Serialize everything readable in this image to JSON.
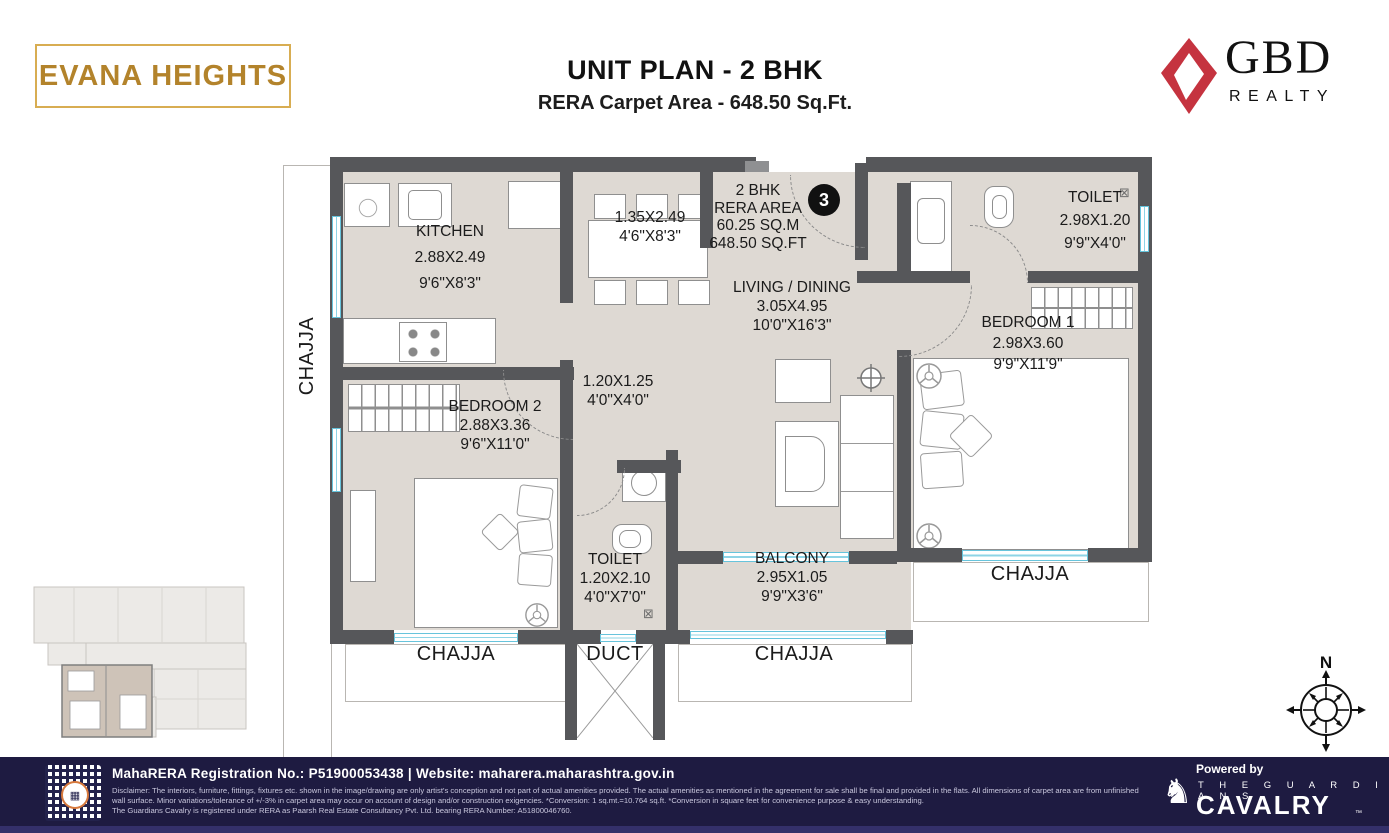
{
  "header": {
    "logo_text": "EVANA HEIGHTS",
    "title": "UNIT PLAN - 2 BHK",
    "subtitle": "RERA Carpet Area - 648.50 Sq.Ft.",
    "brand_name": "GBD",
    "brand_sub": "REALTY",
    "brand_color": "#c5333f",
    "gold_color": "#b3832b"
  },
  "plan": {
    "unit_number": "3",
    "area_block": {
      "l1": "2 BHK",
      "l2": "RERA AREA",
      "l3": "60.25 SQ.M",
      "l4": "648.50 SQ.FT"
    },
    "rooms": {
      "kitchen": {
        "name": "KITCHEN",
        "dim_m": "2.88X2.49",
        "dim_ft": "9'6\"X8'3\""
      },
      "dining": {
        "dim_m": "1.35X2.49",
        "dim_ft": "4'6\"X8'3\""
      },
      "living": {
        "name": "LIVING / DINING",
        "dim_m": "3.05X4.95",
        "dim_ft": "10'0\"X16'3\""
      },
      "toilet1": {
        "name": "TOILET",
        "dim_m": "2.98X1.20",
        "dim_ft": "9'9\"X4'0\""
      },
      "bedroom1": {
        "name": "BEDROOM 1",
        "dim_m": "2.98X3.60",
        "dim_ft": "9'9\"X11'9\""
      },
      "bedroom2": {
        "name": "BEDROOM 2",
        "dim_m": "2.88X3.36",
        "dim_ft": "9'6\"X11'0\""
      },
      "passage": {
        "dim_m": "1.20X1.25",
        "dim_ft": "4'0\"X4'0\""
      },
      "toilet2": {
        "name": "TOILET",
        "dim_m": "1.20X2.10",
        "dim_ft": "4'0\"X7'0\""
      },
      "balcony": {
        "name": "BALCONY",
        "dim_m": "2.95X1.05",
        "dim_ft": "9'9\"X3'6\""
      }
    },
    "labels": {
      "chajja": "CHAJJA",
      "duct": "DUCT"
    },
    "icons": {
      "vent": "⊠"
    },
    "compass_label": "N",
    "wall_color": "#56575a",
    "floor_color": "#ded9d3",
    "window_color": "#8ed4e6"
  },
  "footer": {
    "registration": "MahaRERA Registration No.: P51900053438 | Website: maharera.maharashtra.gov.in",
    "disclaimer": "Disclaimer: The interiors, furniture, fittings, fixtures etc. shown in the image/drawing are only artist's conception and not part of actual amenities provided. The actual amenities as mentioned in the agreement for sale shall be final and provided in the flats. All dimensions of carpet area are from unfinished wall surface. Minor variations/tolerance of +/-3% in carpet area may occur on account of design and/or construction exigencies. *Conversion: 1 sq.mt.=10.764 sq.ft. *Conversion in square feet for convenience purpose & easy understanding.",
    "rera_line": "The Guardians Cavalry is registered under RERA as Paarsh Real Estate Consultancy Pvt. Ltd. bearing RERA Number: A51800046760.",
    "powered_by": "Powered by",
    "partner_top": "T H E   G U A R D I A N S",
    "partner_name": "CAVALRY",
    "partner_tm": "™",
    "knight_icon": "♞",
    "qr_glyph": "▦",
    "bg_color": "#1e1b41"
  }
}
